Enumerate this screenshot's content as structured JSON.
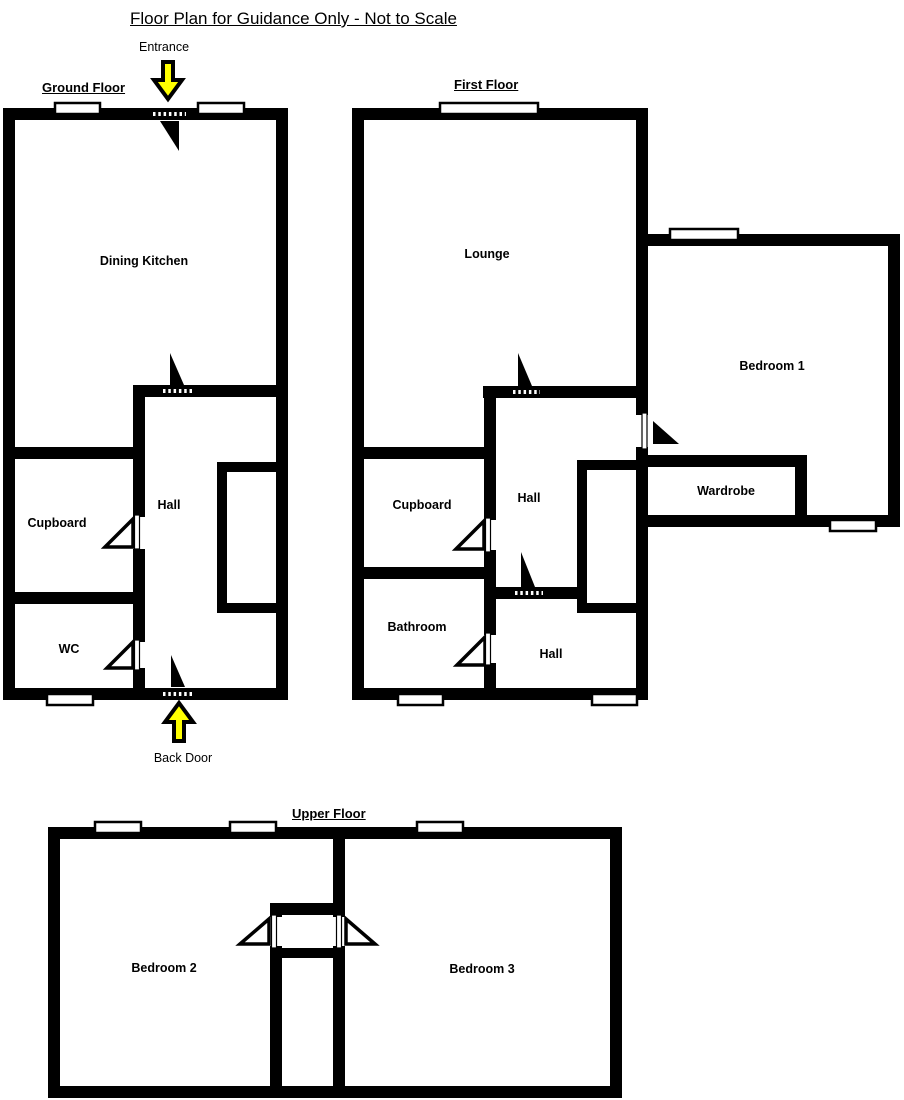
{
  "page_title": "Floor Plan for Guidance Only - Not to Scale",
  "colors": {
    "wall": "#000000",
    "arrow_fill": "#FFFF00",
    "background": "#FFFFFF"
  },
  "annotations": {
    "entrance": "Entrance",
    "back_door": "Back Door"
  },
  "floors": {
    "ground": {
      "title": "Ground Floor",
      "rooms": {
        "dining_kitchen": "Dining Kitchen",
        "cupboard": "Cupboard",
        "hall": "Hall",
        "wc": "WC"
      }
    },
    "first": {
      "title": "First Floor",
      "rooms": {
        "lounge": "Lounge",
        "cupboard": "Cupboard",
        "hall_upper": "Hall",
        "bathroom": "Bathroom",
        "hall_lower": "Hall",
        "bedroom_1": "Bedroom 1",
        "wardrobe": "Wardrobe"
      }
    },
    "upper": {
      "title": "Upper Floor",
      "rooms": {
        "bedroom_2": "Bedroom 2",
        "bedroom_3": "Bedroom 3"
      }
    }
  }
}
